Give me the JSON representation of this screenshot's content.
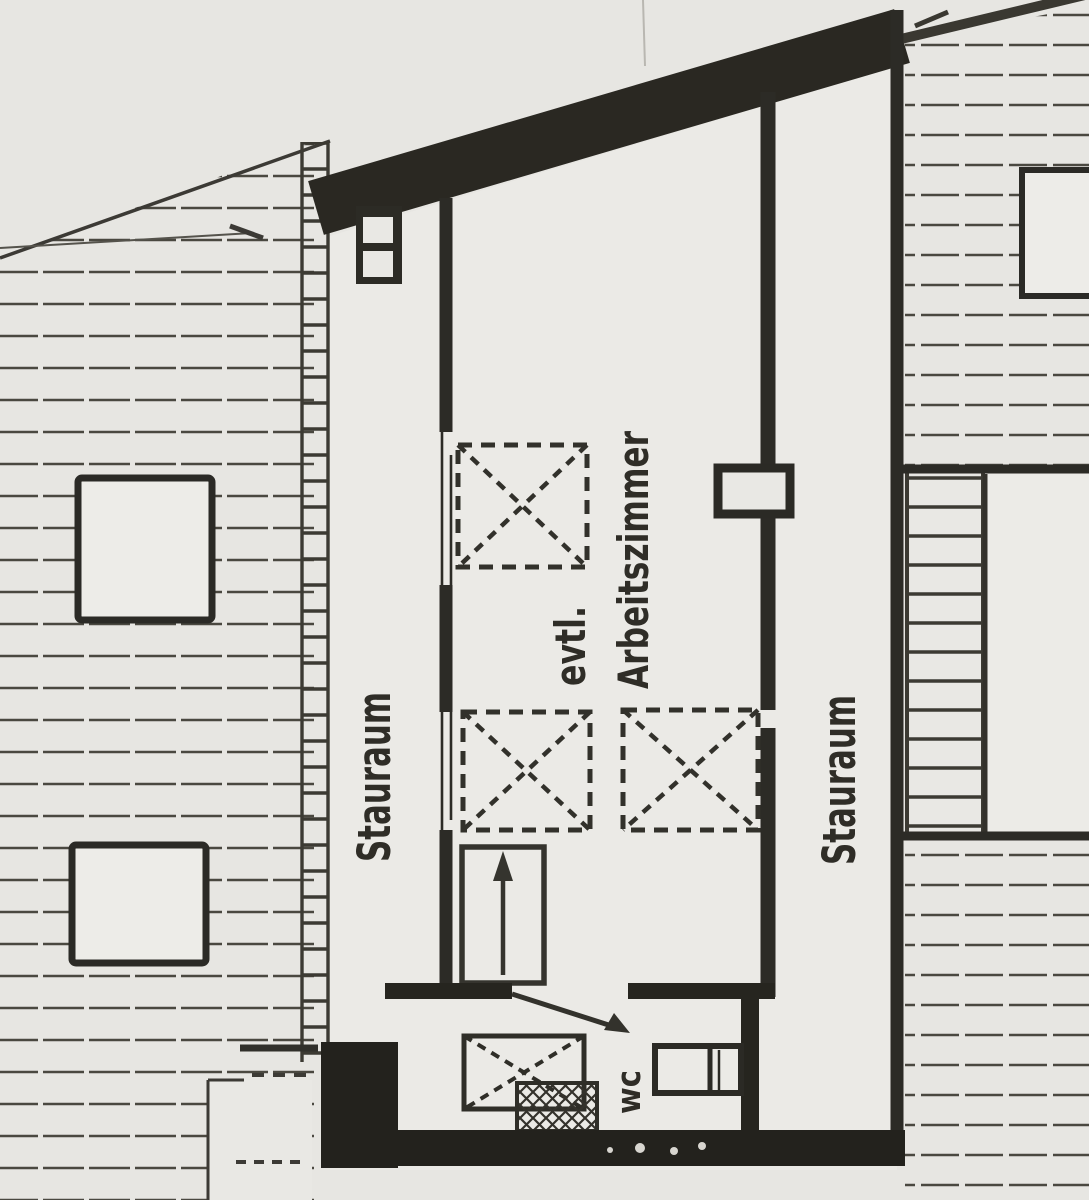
{
  "meta": {
    "title": "Dachgeschoss-Grundriss (Scan)",
    "description": "scanned attic floor plan, photocopy style"
  },
  "plan": {
    "rooms": {
      "storage_left": {
        "label": "Stauraum"
      },
      "study": {
        "label_prefix": "evtl.",
        "label": "Arbeitszimmer"
      },
      "storage_right": {
        "label": "Stauraum"
      },
      "wc": {
        "label": "wc"
      }
    },
    "symbols": {
      "skylight_count": 3,
      "wc_skylight_count": 1,
      "stair_direction": "up"
    },
    "colors": {
      "paper": "#e7e6e2",
      "interior": "#ebeae6",
      "ink": "#35332d",
      "ink_heavy": "#23221d",
      "hatch": "#4a4840"
    }
  }
}
